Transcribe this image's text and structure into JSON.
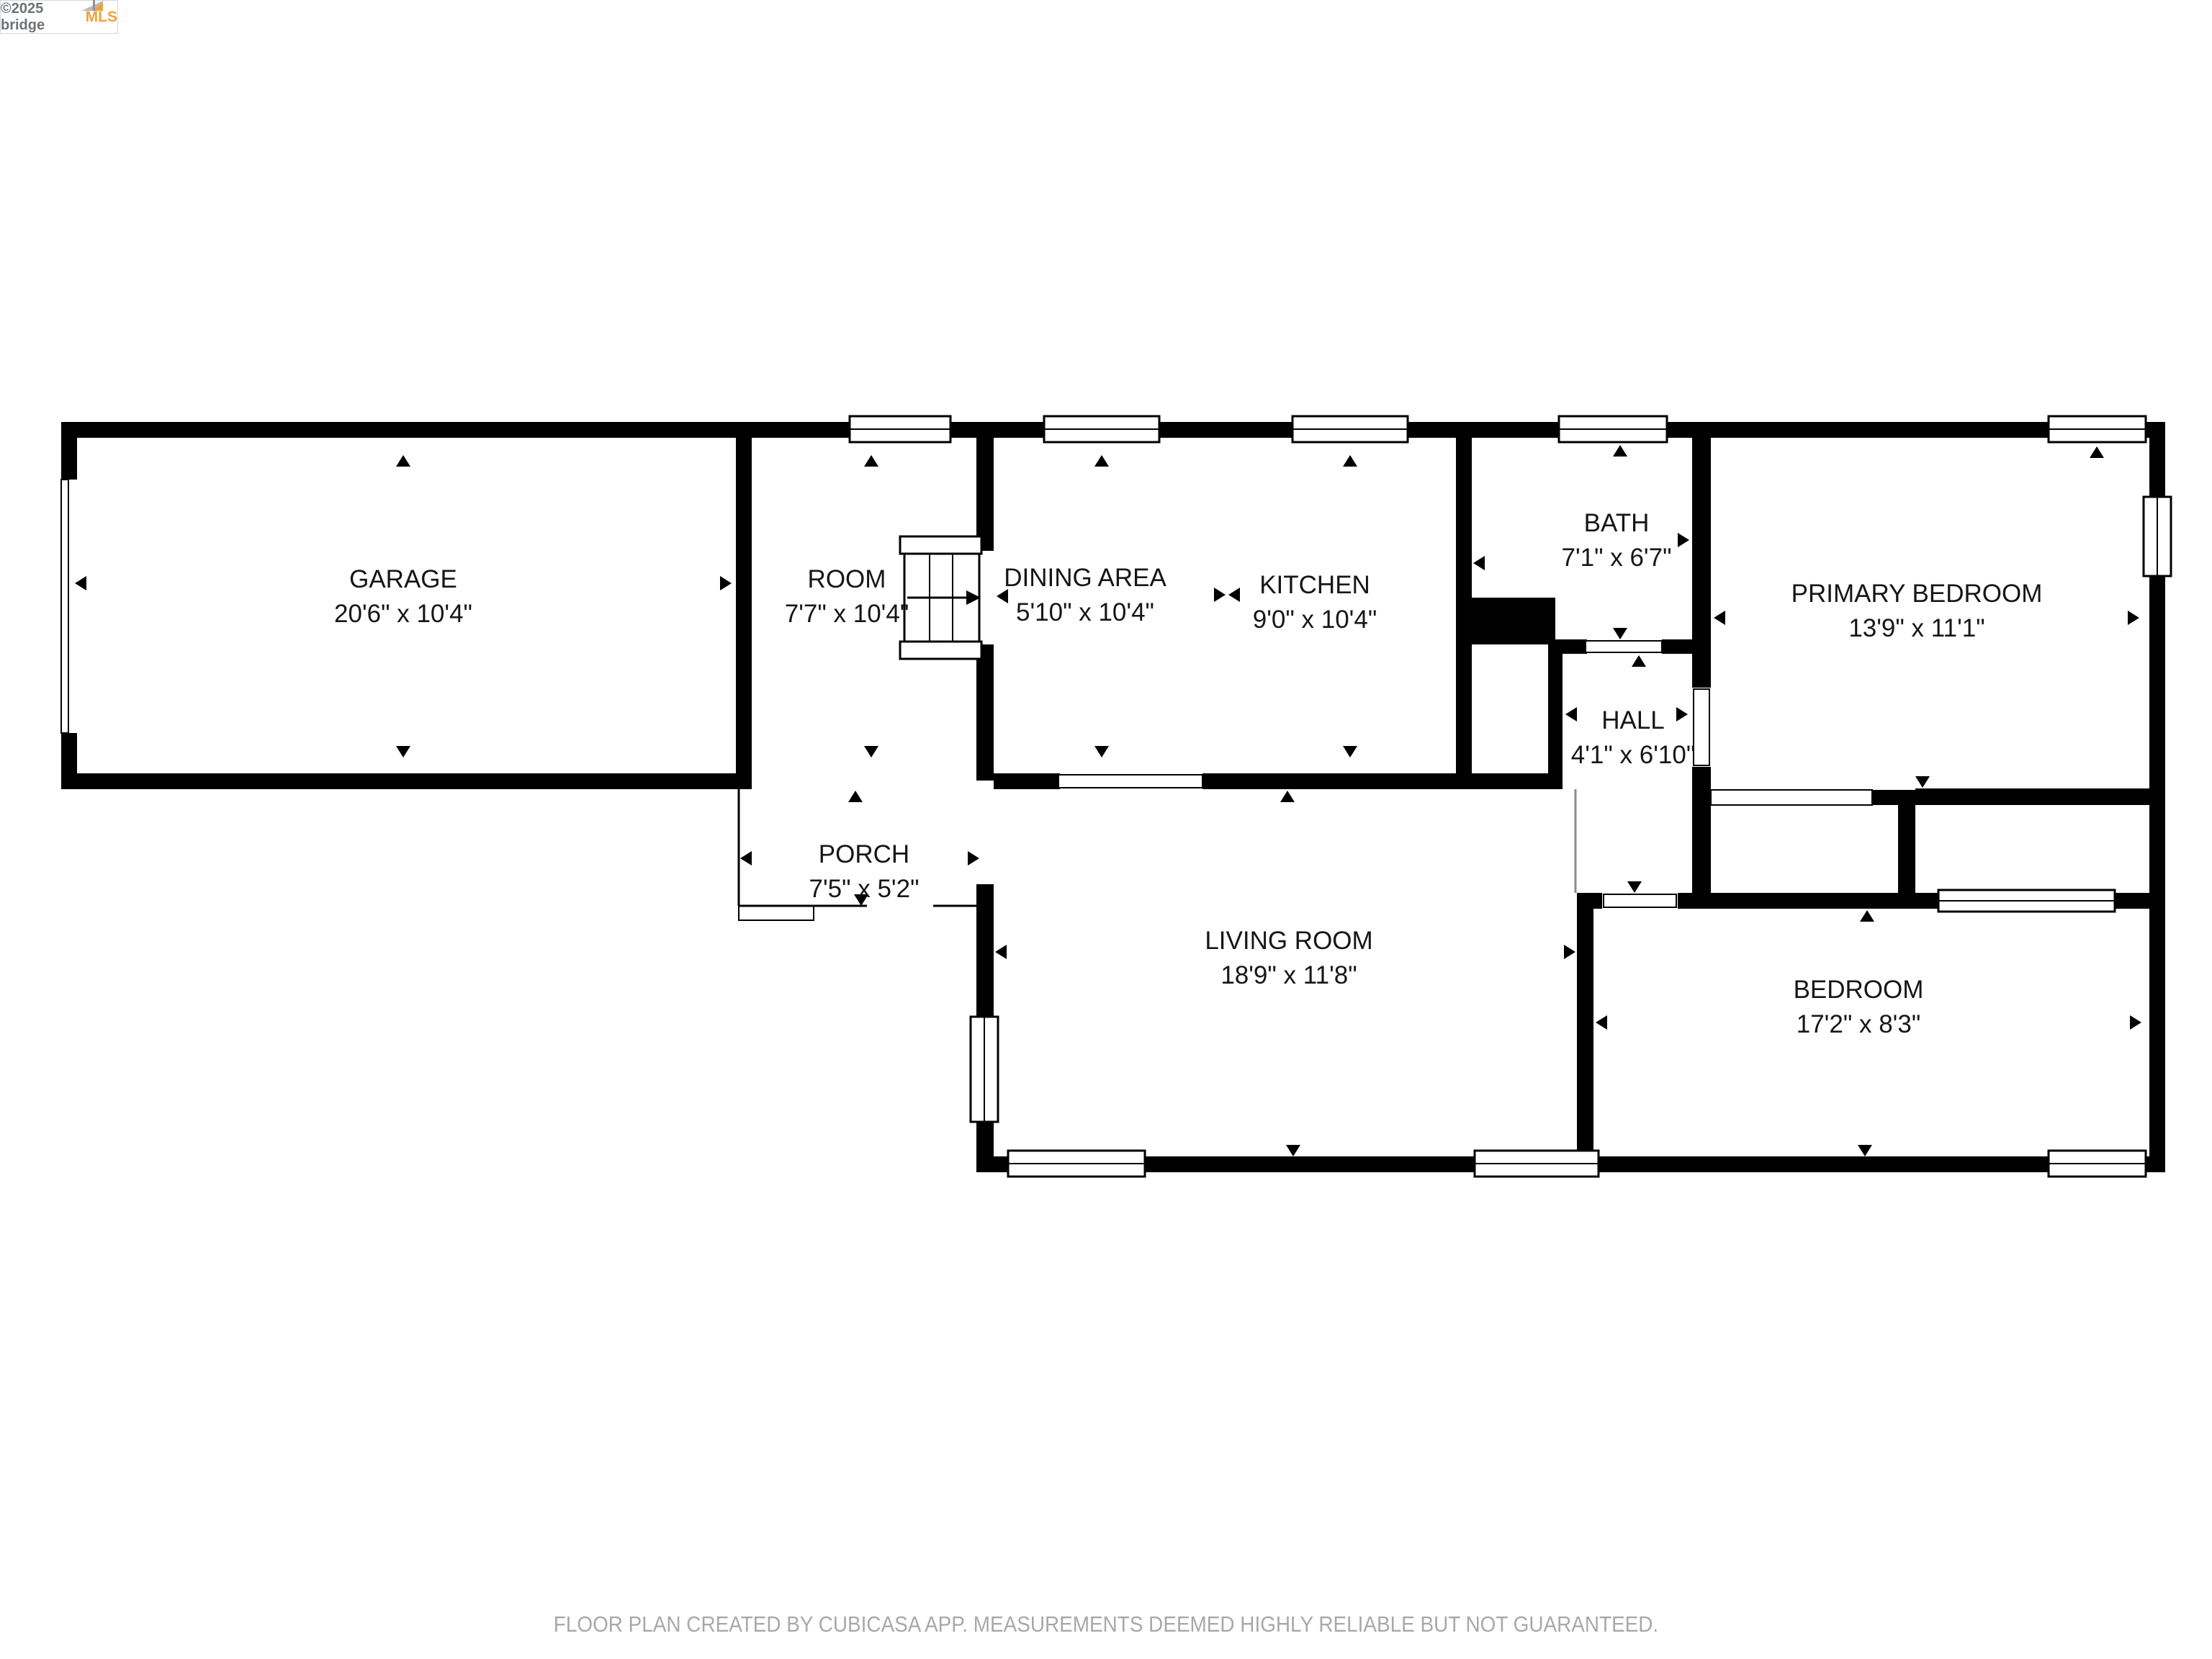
{
  "logo": {
    "copyright": "©2025 bridge",
    "brand": "MLS"
  },
  "rooms": [
    {
      "id": "garage",
      "name": "GARAGE",
      "dims": "20'6\" x 10'4\""
    },
    {
      "id": "room",
      "name": "ROOM",
      "dims": "7'7\" x 10'4\""
    },
    {
      "id": "dining-area",
      "name": "DINING AREA",
      "dims": "5'10\" x 10'4\""
    },
    {
      "id": "kitchen",
      "name": "KITCHEN",
      "dims": "9'0\" x 10'4\""
    },
    {
      "id": "bath",
      "name": "BATH",
      "dims": "7'1\" x 6'7\""
    },
    {
      "id": "primary-bedroom",
      "name": "PRIMARY BEDROOM",
      "dims": "13'9\" x 11'1\""
    },
    {
      "id": "hall",
      "name": "HALL",
      "dims": "4'1\" x 6'10\""
    },
    {
      "id": "porch",
      "name": "PORCH",
      "dims": "7'5\" x 5'2\""
    },
    {
      "id": "living-room",
      "name": "LIVING ROOM",
      "dims": "18'9\" x 11'8\""
    },
    {
      "id": "bedroom",
      "name": "BEDROOM",
      "dims": "17'2\" x 8'3\""
    }
  ],
  "footer": {
    "disclaimer": "FLOOR PLAN CREATED BY CUBICASA APP. MEASUREMENTS DEEMED HIGHLY RELIABLE BUT NOT GUARANTEED."
  },
  "colors": {
    "wall": "#000000",
    "label": "#161616",
    "disclaimer": "#a8a8a8",
    "brand_orange": "#efa23b",
    "logo_gray": "#6d7278"
  }
}
